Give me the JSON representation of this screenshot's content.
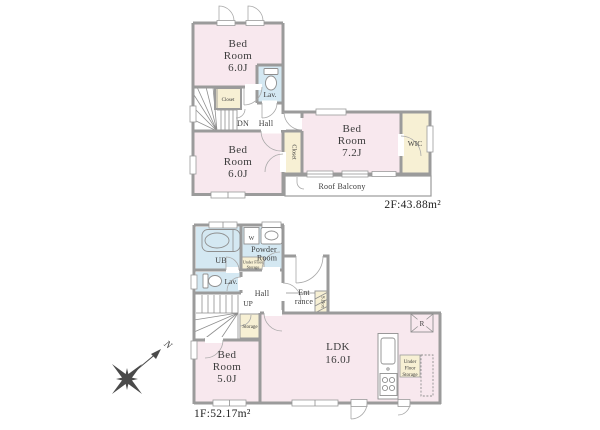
{
  "colors": {
    "room_pink": "#f8e8ee",
    "room_cream": "#f7f0d4",
    "room_blue": "#d4e8f2",
    "wall_gray": "#9b9b9b",
    "text": "#3c3c3c"
  },
  "floor2": {
    "area_label": "2F:43.88m²",
    "bedroom_top": {
      "l1": "Bed",
      "l2": "Room",
      "l3": "6.0J"
    },
    "bedroom_left": {
      "l1": "Bed",
      "l2": "Room",
      "l3": "6.0J"
    },
    "bedroom_main": {
      "l1": "Bed",
      "l2": "Room",
      "l3": "7.2J"
    },
    "closet_top": "Closet",
    "closet_side": "Closet",
    "wic": "WIC",
    "lav": "Lav.",
    "dn": "DN",
    "hall": "Hall",
    "roof_balcony": "Roof Balcony"
  },
  "floor1": {
    "area_label": "1F:52.17m²",
    "ub": "UB",
    "washer": "W",
    "powder": {
      "l1": "Powder",
      "l2": "Room"
    },
    "ufs_powder": {
      "l1": "Under Floor",
      "l2": "Storage"
    },
    "lav": "Lav.",
    "hall": "Hall",
    "up": "UP",
    "entrance": {
      "l1": "Ent",
      "l2": "rance"
    },
    "sbox": "S.Box",
    "storage": "Storage",
    "bedroom": {
      "l1": "Bed",
      "l2": "Room",
      "l3": "5.0J"
    },
    "ldk": {
      "l1": "LDK",
      "l2": "16.0J"
    },
    "fridge": "R",
    "ufs_ldk": {
      "l1": "Under",
      "l2": "Floor",
      "l3": "Storage"
    }
  },
  "compass": {
    "north": "N"
  }
}
